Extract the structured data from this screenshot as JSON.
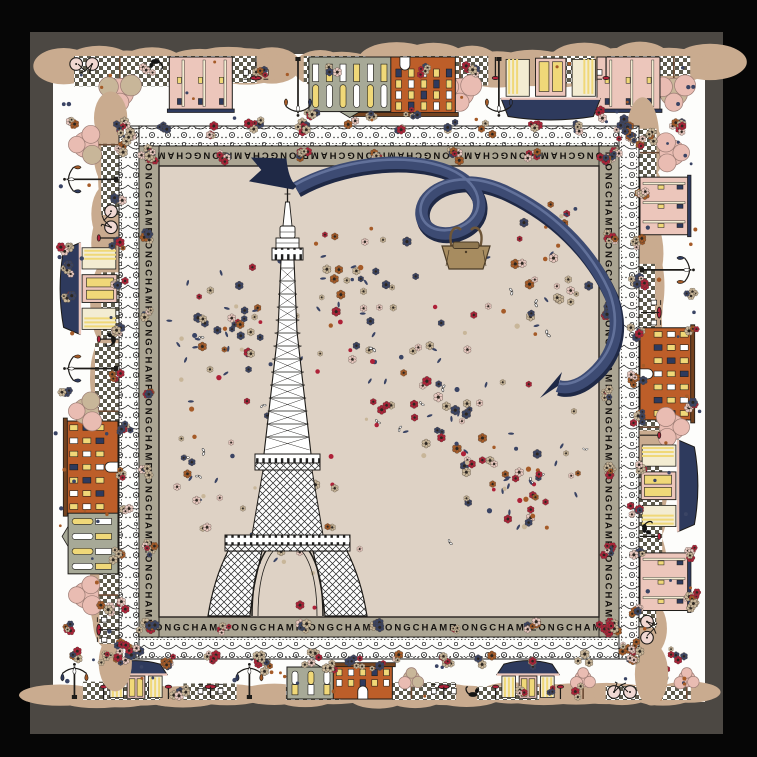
{
  "product": {
    "brand": "LONGCHAMP"
  },
  "border_text": {
    "word": "LONGCHAMP",
    "repeats_per_side": 6
  },
  "colors": {
    "page_bg": "#060606",
    "frame": "#4c4843",
    "scarf": "#fdfdfb",
    "field": "#ded2c5",
    "band_bg": "#aba593",
    "ink": "#1d1b18",
    "tan": "#c9ab8f",
    "checker": "#5e5b4d",
    "orange": "#bd5e29",
    "roof_brown": "#74431f",
    "bldg_gray": "#a7a997",
    "bldg_pink": "#ecc6bb",
    "cream": "#f3ecd2",
    "window_yellow": "#f0d878",
    "navy": "#2e3a5d",
    "ribbon": "#3d4b73",
    "ribbon_dark": "#1f2946",
    "ribbon_lite": "#66769f",
    "red": "#ae2138",
    "rust": "#a55b28",
    "tree_pink": "#e9bcb2",
    "conf_tan": "#c8b699",
    "conf_pink": "#e8c8c0",
    "conf_navy": "#3a4464",
    "bag": "#a78c60",
    "bag_dark": "#6e5638",
    "bag_flap": "#8f7750",
    "white": "#ffffff"
  },
  "scene": {
    "top": [
      {
        "t": "tree",
        "p": 0.045
      },
      {
        "t": "b_pink",
        "p": 0.115
      },
      {
        "t": "table",
        "p": 0.175
      },
      {
        "t": "kiosk",
        "p": 0.235
      },
      {
        "t": "lamp",
        "p": 0.315
      },
      {
        "t": "tree",
        "p": 0.375
      },
      {
        "t": "b_orange",
        "p": 0.46
      },
      {
        "t": "b_gray",
        "p": 0.545
      },
      {
        "t": "lamp",
        "p": 0.625
      },
      {
        "t": "table",
        "p": 0.69
      },
      {
        "t": "b_pink",
        "p": 0.775
      },
      {
        "t": "cat",
        "p": 0.845
      },
      {
        "t": "tree",
        "p": 0.9
      },
      {
        "t": "bike",
        "p": 0.955
      }
    ],
    "bottom": [
      {
        "t": "lamp",
        "p": 0.03
      },
      {
        "t": "kiosk",
        "p": 0.125
      },
      {
        "t": "table",
        "p": 0.24
      },
      {
        "t": "lamp",
        "p": 0.3
      },
      {
        "t": "b_gray",
        "p": 0.395
      },
      {
        "t": "b_orange",
        "p": 0.475
      },
      {
        "t": "tree",
        "p": 0.55
      },
      {
        "t": "table",
        "p": 0.6
      },
      {
        "t": "cat",
        "p": 0.645
      },
      {
        "t": "kiosk",
        "p": 0.73
      },
      {
        "t": "tree",
        "p": 0.815
      },
      {
        "t": "bike",
        "p": 0.875
      },
      {
        "t": "lamp",
        "p": 0.925
      },
      {
        "t": "tree",
        "p": 0.975
      }
    ],
    "left": [
      {
        "t": "table",
        "p": 0.055
      },
      {
        "t": "tree",
        "p": 0.12
      },
      {
        "t": "b_gray",
        "p": 0.23
      },
      {
        "t": "b_orange",
        "p": 0.36
      },
      {
        "t": "tree",
        "p": 0.465
      },
      {
        "t": "lamp",
        "p": 0.545
      },
      {
        "t": "cat",
        "p": 0.6
      },
      {
        "t": "kiosk",
        "p": 0.695
      },
      {
        "t": "bike",
        "p": 0.825
      },
      {
        "t": "lamp",
        "p": 0.9
      },
      {
        "t": "tree",
        "p": 0.965
      }
    ],
    "right": [
      {
        "t": "tree",
        "p": 0.05
      },
      {
        "t": "b_pink",
        "p": 0.15
      },
      {
        "t": "lamp",
        "p": 0.27
      },
      {
        "t": "table",
        "p": 0.35
      },
      {
        "t": "b_orange",
        "p": 0.465
      },
      {
        "t": "tree",
        "p": 0.565
      },
      {
        "t": "kiosk",
        "p": 0.675
      },
      {
        "t": "cat",
        "p": 0.755
      },
      {
        "t": "b_pink",
        "p": 0.855
      },
      {
        "t": "bike",
        "p": 0.945
      }
    ]
  },
  "confetti": {
    "seed": 11,
    "ring_seed": 29,
    "clusters": [
      {
        "cx": 225,
        "cy": 330,
        "rx": 78,
        "ry": 95,
        "n": 55
      },
      {
        "cx": 360,
        "cy": 295,
        "rx": 62,
        "ry": 80,
        "n": 38
      },
      {
        "cx": 432,
        "cy": 400,
        "rx": 72,
        "ry": 70,
        "n": 45
      },
      {
        "cx": 520,
        "cy": 478,
        "rx": 78,
        "ry": 78,
        "n": 52
      },
      {
        "cx": 540,
        "cy": 300,
        "rx": 60,
        "ry": 58,
        "n": 24
      },
      {
        "cx": 300,
        "cy": 530,
        "rx": 85,
        "ry": 60,
        "n": 26
      },
      {
        "cx": 200,
        "cy": 480,
        "rx": 62,
        "ry": 62,
        "n": 20
      },
      {
        "cx": 379,
        "cy": 390,
        "rx": 218,
        "ry": 212,
        "n": 42
      },
      {
        "cx": 300,
        "cy": 610,
        "rx": 45,
        "ry": 9,
        "n": 10
      },
      {
        "cx": 560,
        "cy": 225,
        "rx": 50,
        "ry": 40,
        "n": 14
      }
    ]
  }
}
